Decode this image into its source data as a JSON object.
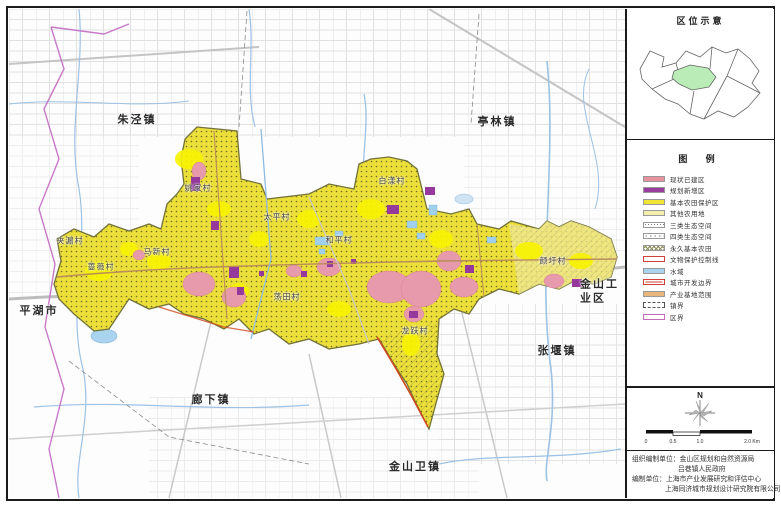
{
  "colors": {
    "existing_built": "#e8919f",
    "planned_new": "#993d9e",
    "basic_farmland": "#f2e434",
    "other_farmland": "#f5efad",
    "water": "#a9d4ee",
    "urban_boundary_red": "#d2403a",
    "industry_orange": "#e9b77c",
    "district_line_purple": "#c06ac0",
    "location_highlight_green": "#b9ecb7",
    "road_gray": "#c9c9c9",
    "river_blue": "#9cc2e5"
  },
  "map": {
    "towns": [
      {
        "name": "朱泾镇"
      },
      {
        "name": "亭林镇"
      },
      {
        "name": "平湖市"
      },
      {
        "name": "廊下镇"
      },
      {
        "name": "金山卫镇"
      },
      {
        "name": "张堰镇"
      },
      {
        "name": "金山工业区"
      }
    ],
    "villages": [
      {
        "name": "姚家村"
      },
      {
        "name": "夹漏村"
      },
      {
        "name": "蔷薇村"
      },
      {
        "name": "马新村"
      },
      {
        "name": "太平村"
      },
      {
        "name": "和平村"
      },
      {
        "name": "荡田村"
      },
      {
        "name": "白漾村"
      },
      {
        "name": "龙跃村"
      },
      {
        "name": "颜圩村"
      }
    ]
  },
  "panel": {
    "location_title": "区位示意",
    "legend_title": "图  例",
    "legend_items": [
      {
        "label": "现状已建区"
      },
      {
        "label": "规划新增区"
      },
      {
        "label": "基本农田保护区"
      },
      {
        "label": "其他农用地"
      },
      {
        "label": "三类生态空间"
      },
      {
        "label": "四类生态空间"
      },
      {
        "label": "永久基本农田"
      },
      {
        "label": "文物保护控制线"
      },
      {
        "label": "水域"
      },
      {
        "label": "城市开发边界"
      },
      {
        "label": "产业基地范围"
      },
      {
        "label": "镇界"
      },
      {
        "label": "区界"
      }
    ],
    "compass_label": "N",
    "scale_labels": [
      "0",
      "0.5",
      "1.0",
      "2.0 Km"
    ],
    "credits": [
      "组织编制单位：金山区规划和自然资源局",
      "吕巷镇人民政府",
      "编制单位：上海市产业发展研究和评估中心",
      "上海同济城市规划设计研究院有限公司"
    ]
  }
}
